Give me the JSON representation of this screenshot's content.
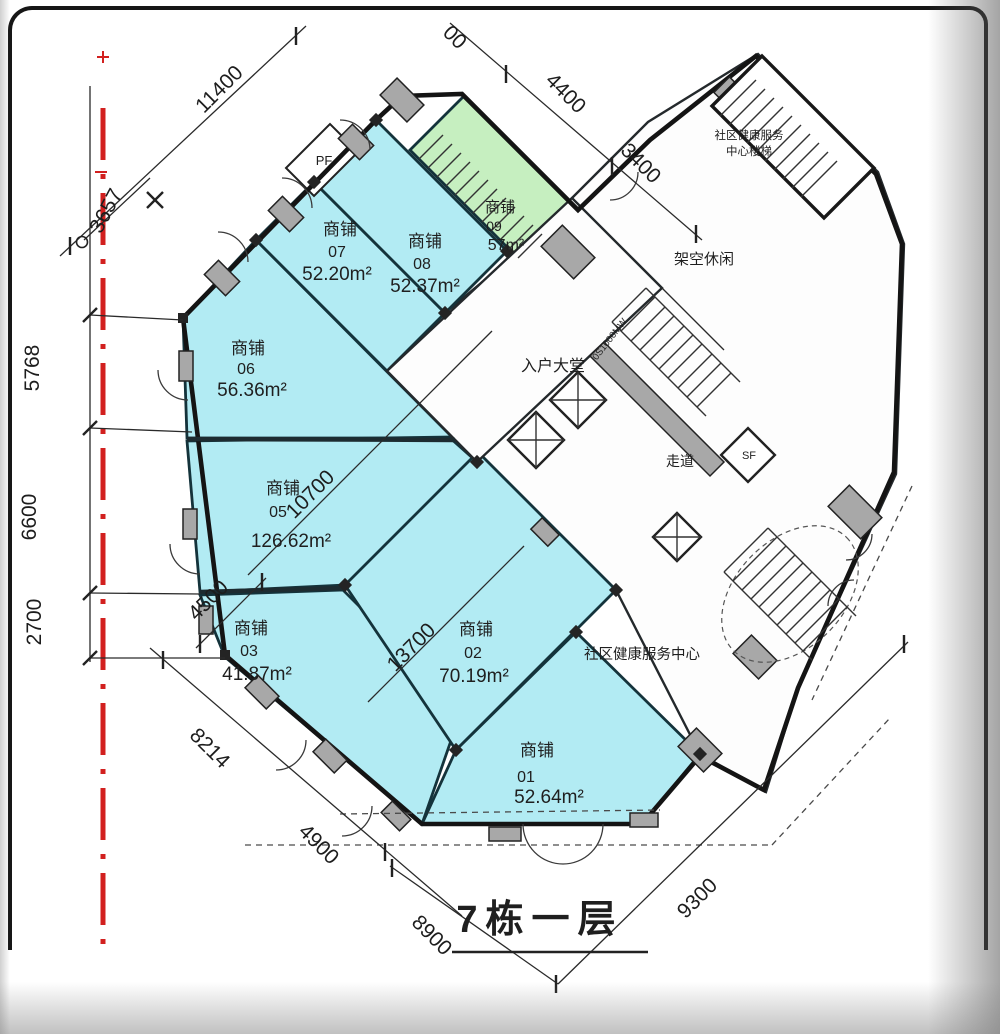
{
  "title": "7栋一层",
  "palette": {
    "shop_fill": "#b2ebf3",
    "shop09_fill": "#c6efc0",
    "wall_gray": "#a8a8a8",
    "wall_dark": "#14333b",
    "ink": "#1f1f1f",
    "red_line": "#d2201f"
  },
  "shops": [
    {
      "label": "商铺",
      "number": "01",
      "area": "52.64m²"
    },
    {
      "label": "商铺",
      "number": "02",
      "area": "70.19m²"
    },
    {
      "label": "商铺",
      "number": "03",
      "area": "41.87m²"
    },
    {
      "label": "商铺",
      "number": "05",
      "area": "126.62m²"
    },
    {
      "label": "商铺",
      "number": "06",
      "area": "56.36m²"
    },
    {
      "label": "商铺",
      "number": "07",
      "area": "52.20m²"
    },
    {
      "label": "商铺",
      "number": "08",
      "area": "52.37m²"
    },
    {
      "label": "商铺",
      "number": "09",
      "area": "57m²"
    }
  ],
  "rooms": {
    "lobby": "入户大堂",
    "corridor": "走道",
    "leisure": "架空休闲",
    "health_center": "社区健康服务中心",
    "stair_label_line1": "社区健康服务",
    "stair_label_line2": "中心楼梯",
    "shaft_sf": "SF",
    "shaft_pf": "PF",
    "elevator_note": "0S1000MW"
  },
  "dimensions": {
    "top": [
      "11400",
      "00",
      "4400",
      "3400"
    ],
    "left": [
      "3657",
      "5768",
      "6600",
      "2700"
    ],
    "bottom": [
      "8214",
      "4900",
      "8900",
      "9300"
    ],
    "interior": [
      "10700",
      "13700",
      "4500"
    ]
  }
}
